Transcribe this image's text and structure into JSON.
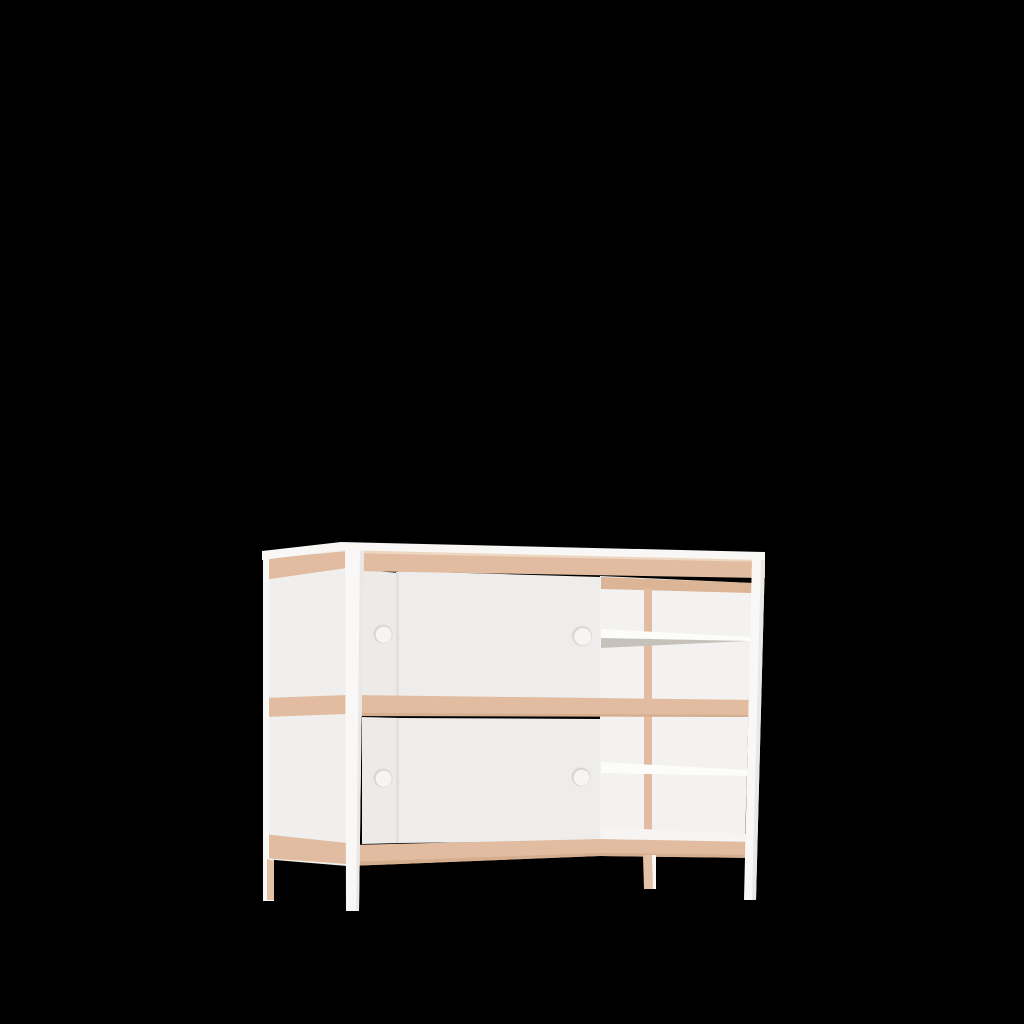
{
  "scene": {
    "object": "dresser-shelf-frame",
    "style": "3d-product-render",
    "background_note": "solid black backdrop"
  },
  "colors": {
    "background": "#000000",
    "slab_white": "#f8f7f6",
    "side_white": "#f1efed",
    "door_white": "#efedeb",
    "door_back_white": "#edebe8",
    "back_panel": "#f4f2f0",
    "wood": "#e1bca0",
    "wood_light": "#eed7c0",
    "wood_shade": "#d5ad8f",
    "wood_inner": "#dcb496",
    "post_white": "#f9f8f7",
    "post_shade": "#eae8e6",
    "shelf_white": "#fcfcfb",
    "shelf_gray": "#c6c1bb",
    "floor_white": "#f6f5f3",
    "hole_fill": "#f6f5f4",
    "hole_rim": "#dad7d3",
    "seam": "#e2dfdc",
    "leg_wood": "#e2c1a7"
  }
}
